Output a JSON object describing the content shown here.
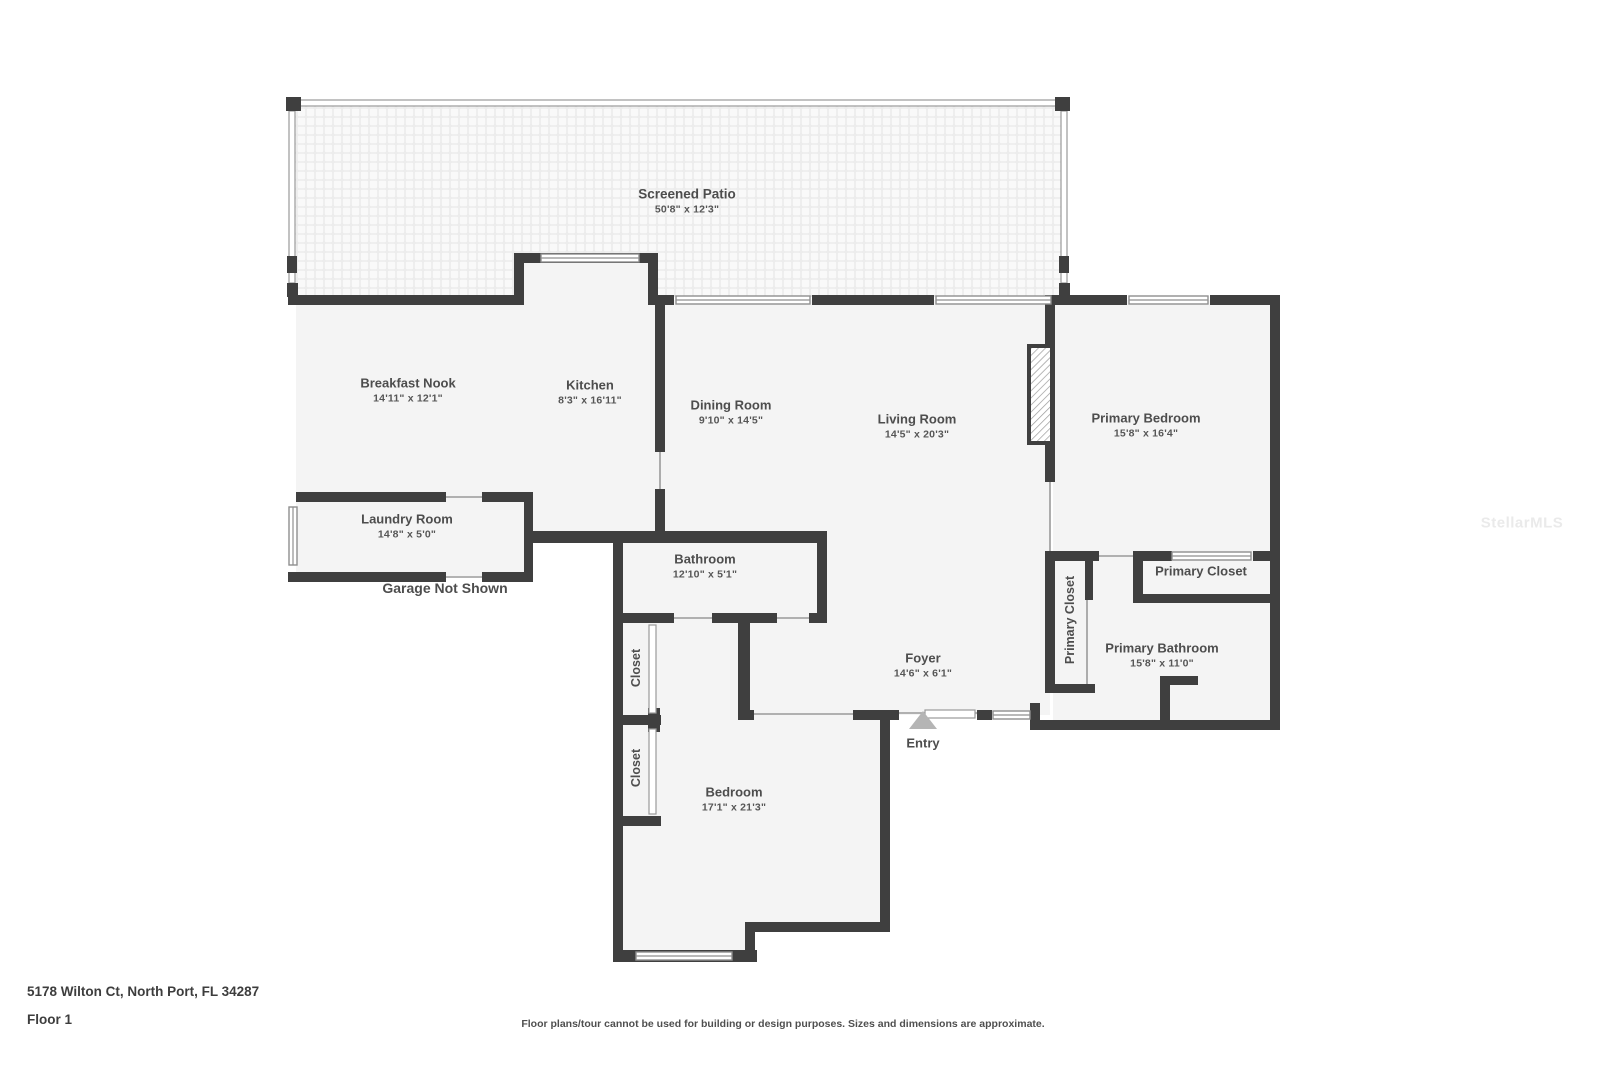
{
  "watermark": "StellarMLS",
  "colors": {
    "wall": "#3f3f3f",
    "room_fill": "#f4f4f4",
    "text": "#4d4d4d",
    "entry_arrow": "#b5b5b5"
  },
  "rooms": {
    "screened_patio": {
      "name": "Screened Patio",
      "dims": "50'8\" x 12'3\""
    },
    "breakfast_nook": {
      "name": "Breakfast Nook",
      "dims": "14'11\" x 12'1\""
    },
    "kitchen": {
      "name": "Kitchen",
      "dims": "8'3\" x 16'11\""
    },
    "dining_room": {
      "name": "Dining Room",
      "dims": "9'10\" x 14'5\""
    },
    "living_room": {
      "name": "Living Room",
      "dims": "14'5\" x 20'3\""
    },
    "primary_bedroom": {
      "name": "Primary Bedroom",
      "dims": "15'8\" x 16'4\""
    },
    "laundry_room": {
      "name": "Laundry Room",
      "dims": "14'8\" x 5'0\""
    },
    "bathroom": {
      "name": "Bathroom",
      "dims": "12'10\" x 5'1\""
    },
    "foyer": {
      "name": "Foyer",
      "dims": "14'6\" x 6'1\""
    },
    "bedroom": {
      "name": "Bedroom",
      "dims": "17'1\" x 21'3\""
    },
    "primary_bathroom": {
      "name": "Primary Bathroom",
      "dims": "15'8\" x 11'0\""
    }
  },
  "labels": {
    "closet": "Closet",
    "primary_closet": "Primary Closet",
    "garage_note": "Garage Not Shown",
    "entry": "Entry"
  },
  "footer": {
    "address": "5178 Wilton Ct, North Port, FL 34287",
    "floor": "Floor 1",
    "disclaimer": "Floor plans/tour cannot be used for building or design purposes. Sizes and dimensions are approximate."
  }
}
